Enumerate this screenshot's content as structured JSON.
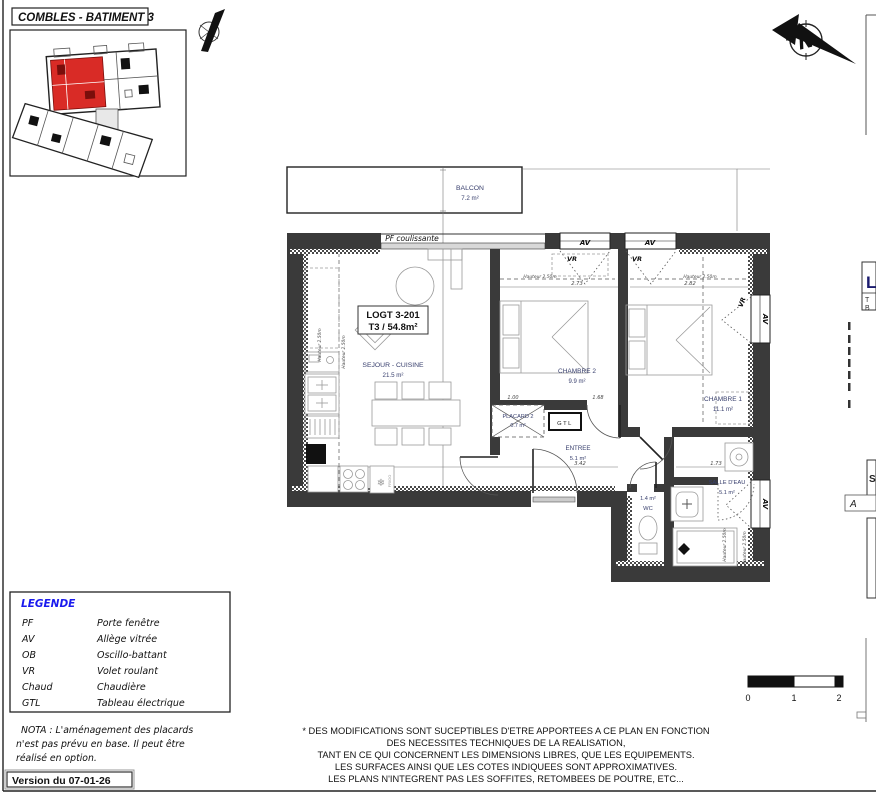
{
  "title": "COMBLES - BATIMENT 3",
  "north": {
    "letter": "N"
  },
  "plan": {
    "unit": {
      "line1": "LOGT 3-201",
      "line2": "T3 / 54.8m²"
    },
    "pf_label": "PF coulissante",
    "av": "AV",
    "vr": "VR",
    "gtl": "GTL",
    "frigo": "FRIGO",
    "rooms": [
      {
        "name": "BALCON",
        "area": "7.2 m²"
      },
      {
        "name": "SEJOUR - CUISINE",
        "area": "21.5 m²"
      },
      {
        "name": "CHAMBRE 2",
        "area": "9.9 m²"
      },
      {
        "name": "CHAMBRE 1",
        "area": "11.1 m²"
      },
      {
        "name": "PLACARD 2",
        "area": "0.7 m²"
      },
      {
        "name": "ENTREE",
        "area": "5.1 m²"
      },
      {
        "name": "WC",
        "area": "1.4 m²"
      },
      {
        "name": "SALLE D'EAU",
        "area": "5.1 m²"
      }
    ],
    "dims": {
      "d1": "2.73",
      "d2": "2.82",
      "d3": "3.42",
      "d4": "1.73",
      "d5": "1.00",
      "d6": "1.68",
      "hauteur": "Hauteur 2.50m"
    }
  },
  "legend": {
    "title": "LEGENDE",
    "items": [
      {
        "abbr": "PF",
        "label": "Porte fenêtre"
      },
      {
        "abbr": "AV",
        "label": "Allège vitrée"
      },
      {
        "abbr": "OB",
        "label": "Oscillo-battant"
      },
      {
        "abbr": "VR",
        "label": "Volet roulant"
      },
      {
        "abbr": "Chaud",
        "label": "Chaudière"
      },
      {
        "abbr": "GTL",
        "label": "Tableau électrique"
      }
    ]
  },
  "nota": [
    "NOTA : L'aménagement des placards",
    "n'est pas prévu en base. Il peut être",
    "réalisé en option."
  ],
  "version": "Version du 07-01-26",
  "disclaimer": [
    "* DES MODIFICATIONS SONT SUCEPTIBLES D'ETRE APPORTEES A CE PLAN EN FONCTION",
    "DES NECESSITES TECHNIQUES DE LA REALISATION,",
    "TANT EN CE QUI CONCERNENT LES DIMENSIONS LIBRES, QUE LES EQUIPEMENTS.",
    "LES SURFACES AINSI QUE LES COTES INDIQUEES SONT APPROXIMATIVES.",
    "LES PLANS N'INTEGRENT PAS LES SOFFITES, RETOMBEES DE POUTRE, ETC..."
  ],
  "scale": {
    "t0": "0",
    "t1": "1",
    "t2": "2"
  },
  "edge": {
    "l1": "L",
    "l2": "T",
    "l3": "B",
    "s": "S",
    "a": "A"
  },
  "colors": {
    "unit_red": "#d92b26",
    "legend_blue": "#1a1aee",
    "wall": "#3a3a3a"
  }
}
